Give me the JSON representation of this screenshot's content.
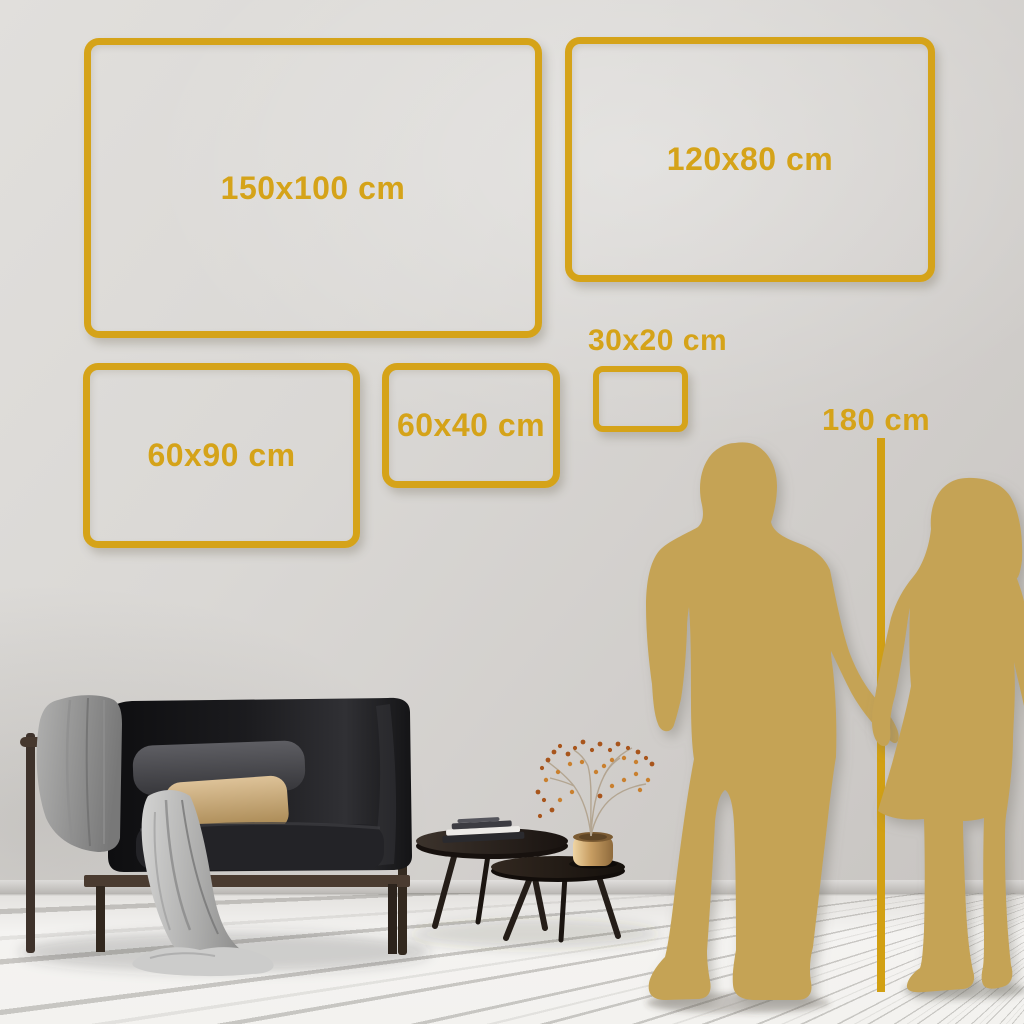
{
  "scene_title": "wall-art size comparison guide",
  "frames": [
    {
      "label": "150x100 cm",
      "width_cm": 150,
      "height_cm": 100
    },
    {
      "label": "120x80 cm",
      "width_cm": 120,
      "height_cm": 80
    },
    {
      "label": "60x90 cm",
      "width_cm": 60,
      "height_cm": 90
    },
    {
      "label": "60x40 cm",
      "width_cm": 60,
      "height_cm": 40
    },
    {
      "label": "30x20 cm",
      "width_cm": 30,
      "height_cm": 20
    }
  ],
  "height_reference": {
    "label": "180 cm",
    "value_cm": 180
  },
  "colors": {
    "frame_gold": "#D5A319",
    "silhouette_gold": "#C5A355",
    "wall_gray": "#D8D6D3",
    "floor_white": "#F3F2EF"
  },
  "icons": [
    "man-silhouette",
    "woman-silhouette",
    "height-ruler-line",
    "sofa-illustration",
    "blanket-illustration",
    "coffee-tables-illustration",
    "books-illustration",
    "brass-pot-illustration",
    "plant-illustration"
  ]
}
